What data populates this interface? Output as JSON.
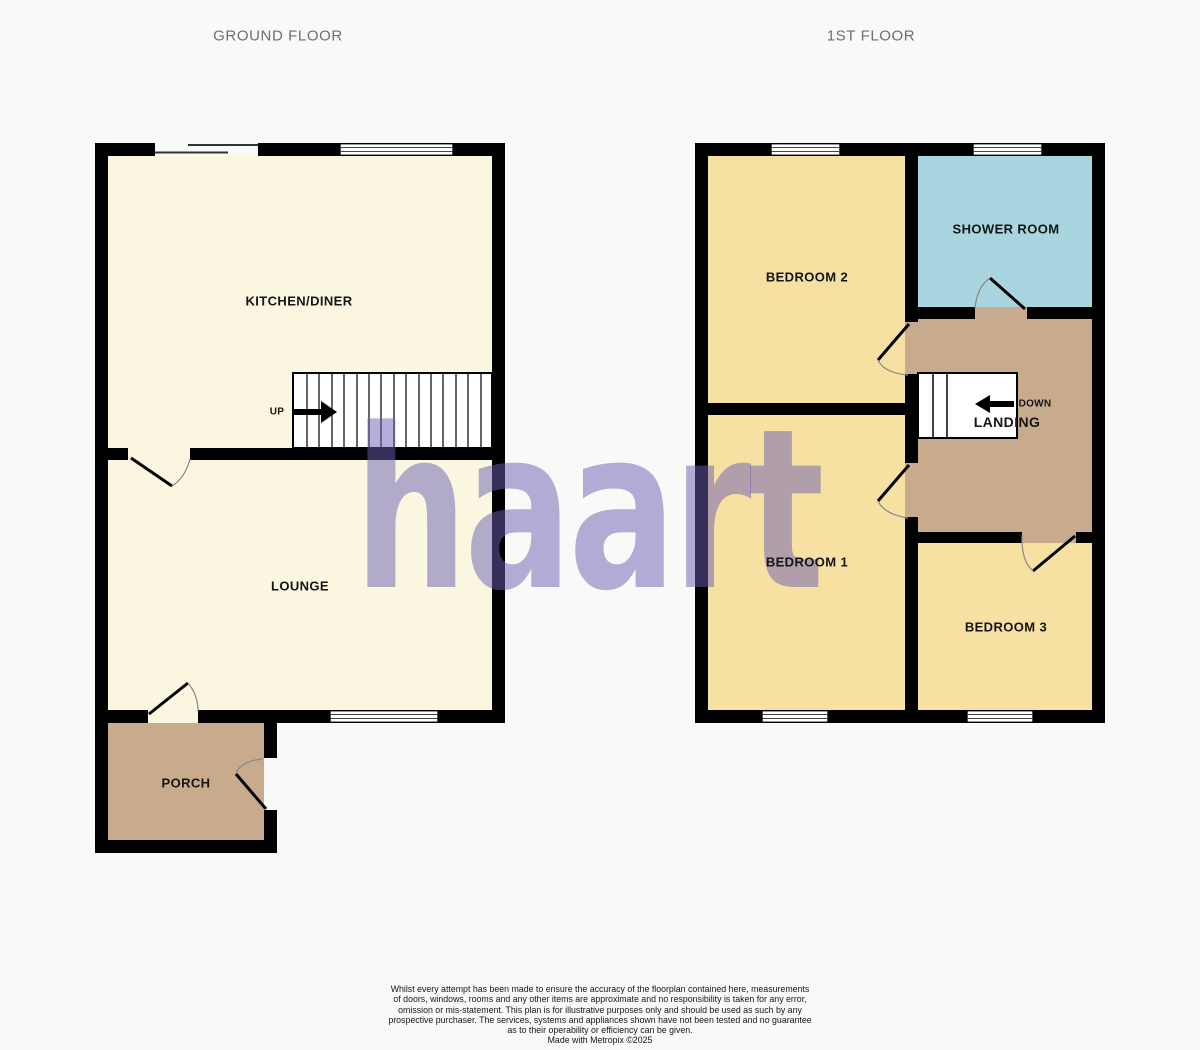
{
  "titles": {
    "ground_floor": "GROUND FLOOR",
    "first_floor": "1ST FLOOR"
  },
  "watermark": {
    "text": "haart",
    "color": "rgba(106,94,179,0.5)"
  },
  "colors": {
    "cream": "#faf6df",
    "yellow": "#f6e1a3",
    "blue": "#a9d5e1",
    "tan": "#c7ab8c",
    "wall": "#000000",
    "stairs": "#ffffff",
    "title_gray": "#6e6e6e"
  },
  "ground_floor": {
    "kitchen_diner": "KITCHEN/DINER",
    "lounge": "LOUNGE",
    "porch": "PORCH",
    "stairs_direction": "UP"
  },
  "first_floor": {
    "bedroom_2": "BEDROOM 2",
    "shower_room": "SHOWER ROOM",
    "bedroom_1": "BEDROOM 1",
    "bedroom_3": "BEDROOM 3",
    "landing": "LANDING",
    "stairs_direction": "DOWN"
  },
  "disclaimer": {
    "lines": [
      "Whilst every attempt has been made to ensure the accuracy of the floorplan contained here, measurements",
      "of doors, windows, rooms and any other items are approximate and no responsibility is taken for any error,",
      "omission or mis-statement. This plan is for illustrative purposes only and should be used as such by any",
      "prospective purchaser. The services, systems and appliances shown have not been tested and no guarantee",
      "as to their operability or efficiency can be given.",
      "Made with Metropix ©2025"
    ]
  }
}
